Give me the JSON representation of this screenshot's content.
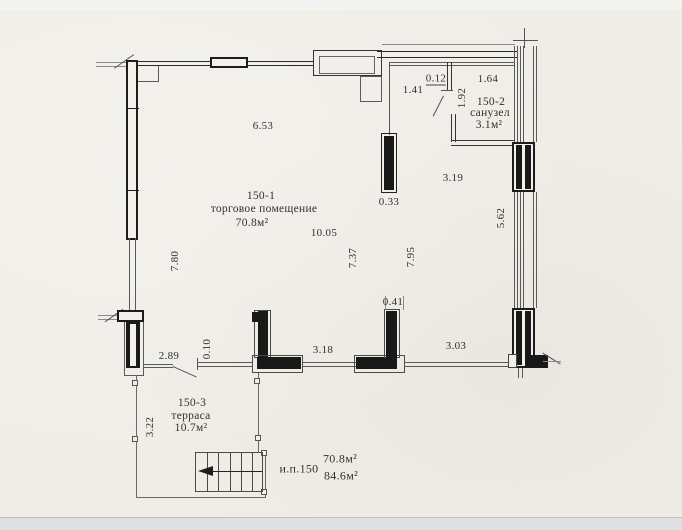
{
  "plan": {
    "rooms": [
      {
        "id": "150-1",
        "name": "торговое помещение",
        "area": "70.8м²"
      },
      {
        "id": "150-2",
        "name": "санузел",
        "area": "3.1м²"
      },
      {
        "id": "150-3",
        "name": "терраса",
        "area": "10.7м²"
      }
    ],
    "summary": {
      "unit": "и.п.150",
      "area_main": "70.8м²",
      "area_total": "84.6м²"
    },
    "dims": {
      "top_width": "6.53",
      "hall_width": "1.41",
      "partition_thickness": "0.12",
      "wc_width": "1.64",
      "wc_door_height": "1.92",
      "hall_depth": "3.19",
      "pier_top": "0.33",
      "right_wall_span": "5.62",
      "left_wall_span": "7.80",
      "room_width": "10.05",
      "room_depth_left": "7.37",
      "room_depth_right": "7.95",
      "pier_bottom": "0.41",
      "terrace_door_width": "2.89",
      "rail_thickness": "0.10",
      "opening_left": "3.18",
      "opening_right": "3.03",
      "terrace_side": "3.22"
    },
    "colors": {
      "paper": "#f0ede7",
      "ink": "#2a2a2a",
      "footer_band": "#dde1e2"
    }
  }
}
